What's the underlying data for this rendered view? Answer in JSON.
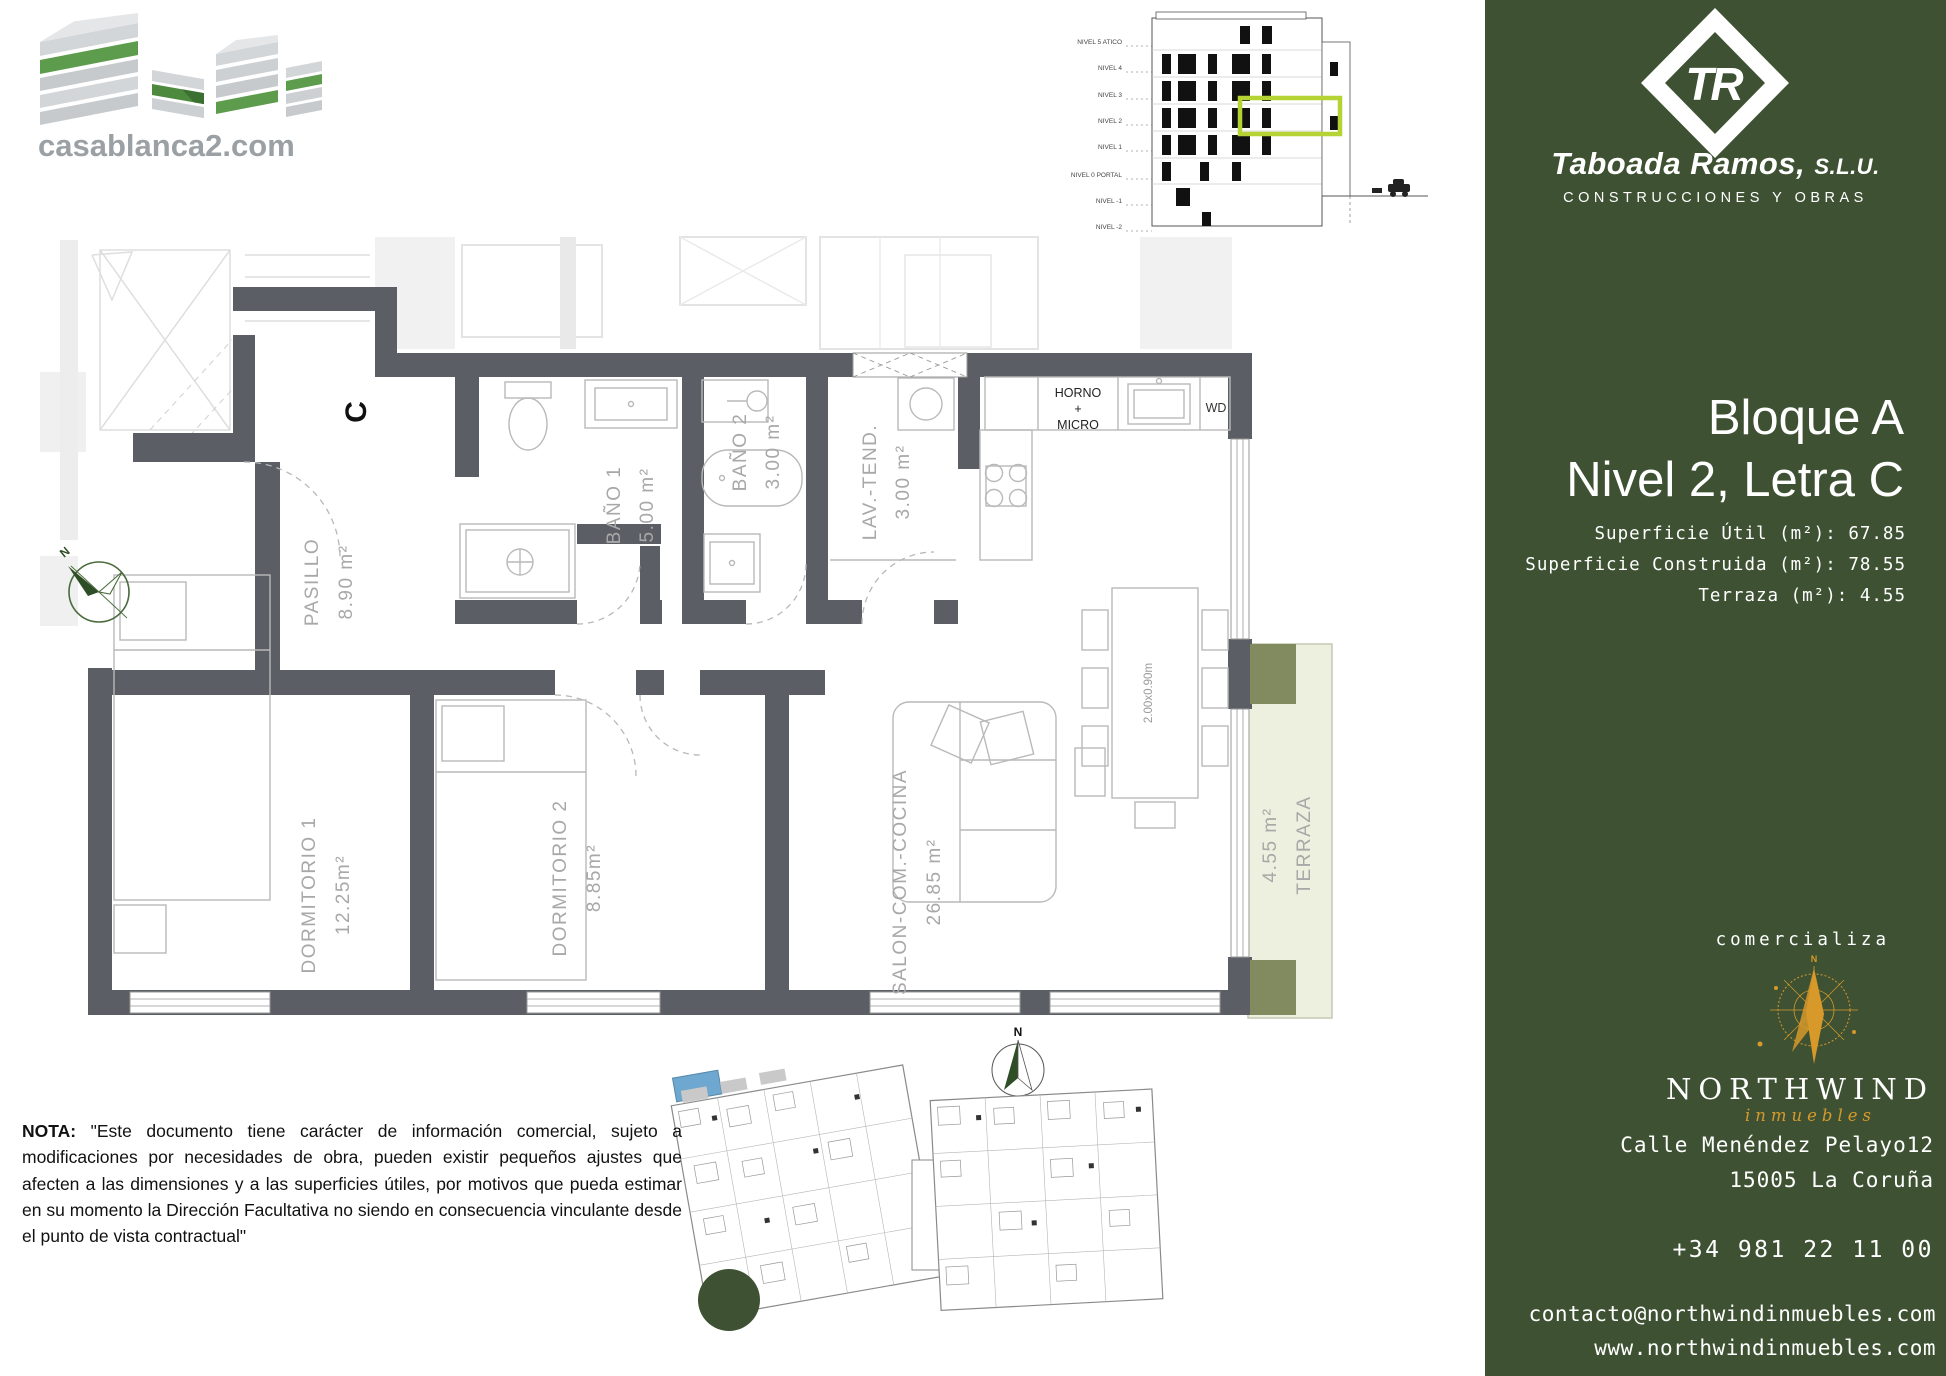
{
  "branding": {
    "casablanca": {
      "domain": "casablanca2.com"
    },
    "taboada": {
      "monogram": "TR",
      "name": "Taboada Ramos,",
      "suffix": "S.L.U.",
      "tagline": "CONSTRUCCIONES Y OBRAS"
    }
  },
  "elevation": {
    "levels": [
      "NIVEL 5 ATICO",
      "NIVEL 4",
      "NIVEL 3",
      "NIVEL 2",
      "NIVEL 1",
      "NIVEL 0 PORTAL",
      "NIVEL -1",
      "NIVEL -2"
    ]
  },
  "unit": {
    "line1": "Bloque A",
    "line2": "Nivel 2, Letra C",
    "areas": [
      {
        "label": "Superficie Útil (m²):",
        "value": "67.85"
      },
      {
        "label": "Superficie Construida (m²):",
        "value": "78.55"
      },
      {
        "label": "Terraza (m²):",
        "value": "4.55"
      }
    ]
  },
  "plan": {
    "unit_letter": "C",
    "north": "N",
    "rooms": [
      {
        "name": "PASILLO",
        "area": "8.90 m²"
      },
      {
        "name": "BAÑO 1",
        "area": "5.00 m²"
      },
      {
        "name": "BAÑO 2",
        "area": "3.00 m²"
      },
      {
        "name": "LAV.-TEND.",
        "area": "3.00 m²"
      },
      {
        "name": "DORMITORIO 1",
        "area": "12.25m²"
      },
      {
        "name": "DORMITORIO 2",
        "area": "8.85m²"
      },
      {
        "name": "SALON-COM.-COCINA",
        "area": "26.85 m²"
      },
      {
        "name": "TERRAZA",
        "area": "4.55 m²"
      }
    ],
    "kitchen": {
      "oven_line1": "HORNO",
      "oven_line2": "+",
      "oven_line3": "MICRO",
      "dishwasher": "WD",
      "table_size": "2.00x0.90m"
    }
  },
  "note": {
    "title": "NOTA:",
    "body": "\"Este documento tiene carácter de información comercial, sujeto a modificaciones por necesidades de obra, pueden existir pequeños ajustes que afecten a las dimensiones y a las superficies útiles, por motivos que pueda estimar en su momento la Dirección Facultativa no siendo en consecuencia vinculante desde el punto de vista contractual\""
  },
  "marketing": {
    "intro": "comercializa",
    "agency_name": "NORTHWIND",
    "agency_sub": "inmuebles",
    "address_line1": "Calle Menéndez Pelayo12",
    "address_line2": "15005 La Coruña",
    "phone": "+34 981 22 11 00",
    "email": "contacto@northwindinmuebles.com",
    "website": "www.northwindinmuebles.com"
  },
  "colors": {
    "sidebar_green": "#3e5233",
    "logo_green": "#5e9c4d",
    "highlight_green": "#b5d334",
    "gold": "#d6992a",
    "wall_gray": "#5b5e64",
    "terraza_fill": "#eef0df"
  }
}
